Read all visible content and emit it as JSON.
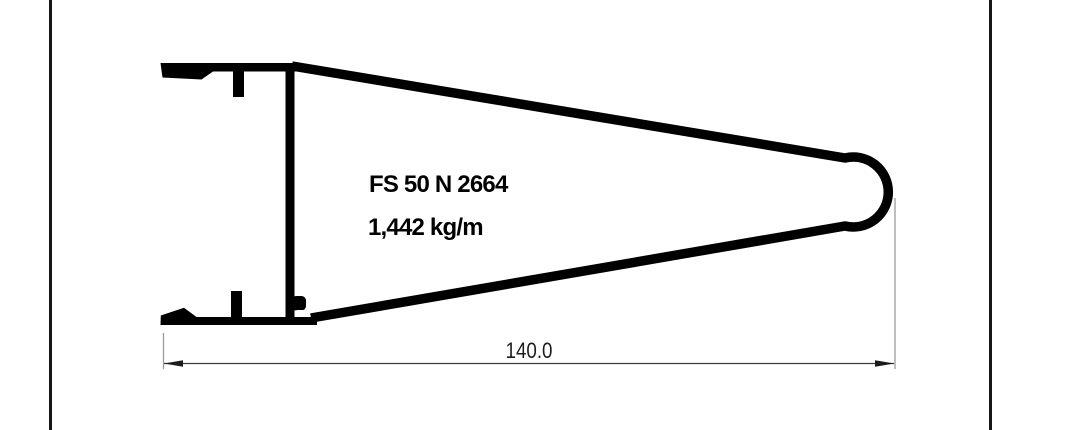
{
  "drawing": {
    "profile_name": "FS 50 N 2664",
    "weight_per_meter": "1,442 kg/m",
    "dimension": {
      "width_label": "140.0"
    },
    "colors": {
      "profile_line": "#000000",
      "dimension_line": "#3c3c3c",
      "extension_line": "#9a9a9a",
      "page_border": "#161616",
      "background": "#ffffff",
      "text": "#000000"
    }
  }
}
